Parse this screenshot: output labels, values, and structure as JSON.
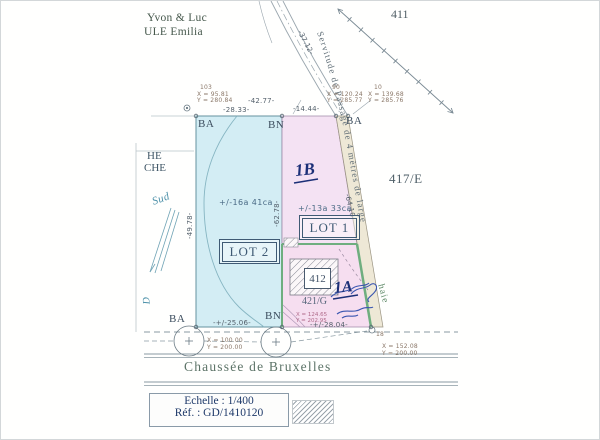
{
  "document": {
    "owner_line1": "Yvon & Luc",
    "owner_line2": "ULE Emilia",
    "street_name": "Chaussée de Bruxelles",
    "scale": "Echelle : 1/400",
    "reference": "Réf. : GD/1410120"
  },
  "parcels": {
    "p411": "411",
    "p417e": "417/E",
    "p421g": "421/G",
    "building_412": "412",
    "lot1": {
      "label": "LOT 1",
      "area": "+/-13a 33ca",
      "hand_note": "1B"
    },
    "lot2": {
      "label": "LOT 2",
      "area": "+/-16a 41ca"
    },
    "lot1_lower_hand_note": "1A"
  },
  "boundary_markers": {
    "top_left": "BA",
    "top_middle": "BN",
    "top_right": "BA",
    "bottom_left": "BA",
    "bottom_middle": "BN"
  },
  "measurements": {
    "top_total": "-42.77-",
    "top_lot2": "-28.33-",
    "top_lot1": "-14.44-",
    "left_side": "-49.78-",
    "lot_divider": "-62.78-",
    "servitude_top": "-37.12-",
    "servitude_side": "-64.10-",
    "bottom_lot2": "-+/-25.06-",
    "bottom_lot1": "-+/-28.04-"
  },
  "survey_points": {
    "p103": {
      "id": "103",
      "x": "X =  95.81",
      "y": "Y = 280.84"
    },
    "p90": {
      "id": "90",
      "x": "X = 120.24",
      "y": "Y = 285.77"
    },
    "p10": {
      "id": "10",
      "x": "X = 139.68",
      "y": "Y = 285.76"
    },
    "sw": {
      "x": "X = 100.00",
      "y": "Y = 200.00"
    },
    "bn": {
      "x": "X = 124.65",
      "y": "Y = 202.95"
    },
    "se": {
      "id": "18",
      "x": "X = 152.08",
      "y": "Y = 200.00"
    }
  },
  "annotations": {
    "servitude": "Servitude de Passage de 4 mètres de large",
    "hedge": "haie",
    "south": "Sud",
    "edge_word1": "HE",
    "edge_word2": "CHE",
    "edge_letter": "D"
  },
  "colors": {
    "lot2_fill": "#d3edf4",
    "lot1_fill": "#f4e2f3",
    "lot1_lower_fill": "#f6def0",
    "servitude_fill": "#eee8d6",
    "hedge_green": "#6fae7f",
    "hand_ink": "#1b2f77",
    "signature_ink": "#3a56b0"
  }
}
